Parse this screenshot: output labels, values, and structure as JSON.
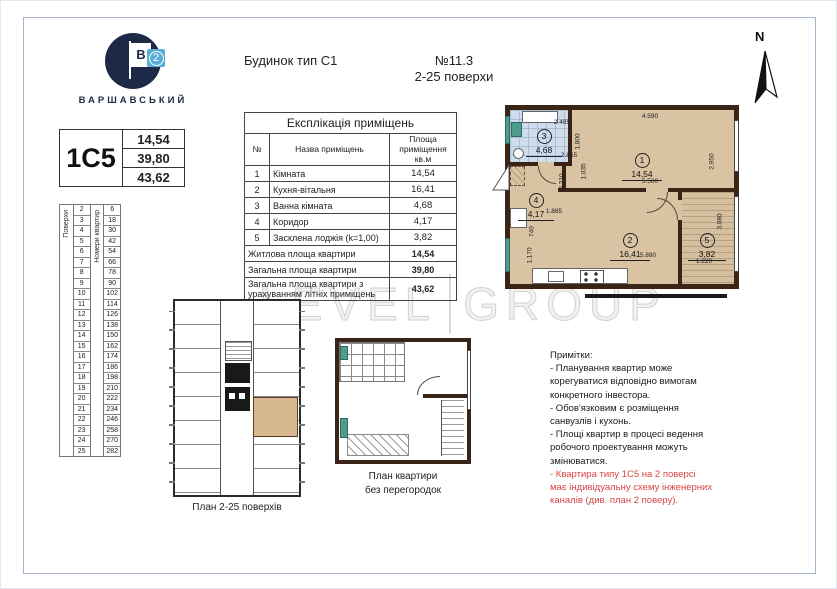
{
  "header": {
    "building_type": "Будинок тип С1",
    "number": "№11.3",
    "floors_range": "2-25 поверхи"
  },
  "brand": {
    "name": "ВАРШАВСЬКИЙ",
    "flag_letter": "В",
    "flag_number": "2"
  },
  "north": {
    "label": "N"
  },
  "apartment_card": {
    "type": "1С5",
    "values": [
      "14,54",
      "39,80",
      "43,62"
    ]
  },
  "floors_table": {
    "col1_label": "Поверхи",
    "col2_label": "Номери квартир",
    "rows": [
      {
        "floor": "2",
        "apt": "6"
      },
      {
        "floor": "3",
        "apt": "18"
      },
      {
        "floor": "4",
        "apt": "30"
      },
      {
        "floor": "5",
        "apt": "42"
      },
      {
        "floor": "6",
        "apt": "54"
      },
      {
        "floor": "7",
        "apt": "66"
      },
      {
        "floor": "8",
        "apt": "78"
      },
      {
        "floor": "9",
        "apt": "90"
      },
      {
        "floor": "10",
        "apt": "102"
      },
      {
        "floor": "11",
        "apt": "114"
      },
      {
        "floor": "12",
        "apt": "126"
      },
      {
        "floor": "13",
        "apt": "138"
      },
      {
        "floor": "14",
        "apt": "150"
      },
      {
        "floor": "15",
        "apt": "162"
      },
      {
        "floor": "16",
        "apt": "174"
      },
      {
        "floor": "17",
        "apt": "186"
      },
      {
        "floor": "18",
        "apt": "198"
      },
      {
        "floor": "19",
        "apt": "210"
      },
      {
        "floor": "20",
        "apt": "222"
      },
      {
        "floor": "21",
        "apt": "234"
      },
      {
        "floor": "22",
        "apt": "246"
      },
      {
        "floor": "23",
        "apt": "258"
      },
      {
        "floor": "24",
        "apt": "270"
      },
      {
        "floor": "25",
        "apt": "282"
      }
    ]
  },
  "explication": {
    "title": "Експлікація приміщень",
    "headers": [
      "№",
      "Назва приміщень",
      "Площа приміщення кв.м"
    ],
    "rows": [
      [
        "1",
        "Кімната",
        "14,54"
      ],
      [
        "2",
        "Кухня-вітальня",
        "16,41"
      ],
      [
        "3",
        "Ванна кімната",
        "4,68"
      ],
      [
        "4",
        "Коридор",
        "4,17"
      ],
      [
        "5",
        "Засклена лоджія (k=1,00)",
        "3,82"
      ]
    ],
    "summary": [
      [
        "Житлова площа квартири",
        "14,54"
      ],
      [
        "Загальна площа квартири",
        "39,80"
      ],
      [
        "Загальна площа квартири з урахуванням літніх приміщень",
        "43,62"
      ]
    ]
  },
  "plan": {
    "rooms": [
      {
        "num": "1",
        "area": "14,54"
      },
      {
        "num": "2",
        "area": "16,41"
      },
      {
        "num": "3",
        "area": "4,68"
      },
      {
        "num": "4",
        "area": "4,17"
      },
      {
        "num": "5",
        "area": "3,82"
      }
    ],
    "dims": {
      "room1_top": "4.590",
      "room1_right": "2.950",
      "room1_bottom": "5.560",
      "bath_top": "2.485",
      "bath_right": "1.800",
      "bath_bottom": "2.855",
      "hall_height": "2.210",
      "hall_right": "1.035",
      "hall_bottom": "1.885",
      "kitchen_left_a": "740",
      "kitchen_left_b": "1.170",
      "kitchen_bottom": "5.880",
      "loggia_right": "3.080",
      "loggia_bottom": "1.220"
    }
  },
  "scalebar": {
    "zero": "0",
    "mid": "2m",
    "end": "5m"
  },
  "watermark": {
    "word1": "LEVEL",
    "word2": "GROUP"
  },
  "captions": {
    "building_plan": "План 2-25 поверхів",
    "no_partitions_1": "План квартири",
    "no_partitions_2": "без перегородок"
  },
  "notes": {
    "lines": [
      {
        "text": "Примітки:",
        "red": false
      },
      {
        "text": "- Планування квартир може",
        "red": false
      },
      {
        "text": "корегуватися відповідно вимогам",
        "red": false
      },
      {
        "text": "конкретного інвестора.",
        "red": false
      },
      {
        "text": "- Обов'язковим є розміщення",
        "red": false
      },
      {
        "text": "санвузлів і кухонь.",
        "red": false
      },
      {
        "text": "- Площі квартир в процесі ведення",
        "red": false
      },
      {
        "text": "робочого проектування можуть",
        "red": false
      },
      {
        "text": "змінюватися.",
        "red": false
      },
      {
        "text": "- Квартира типу 1С5 на 2 поверсі",
        "red": true
      },
      {
        "text": "має індивідуальну схему інженерних",
        "red": true
      },
      {
        "text": "каналів (див. план 2 поверу).",
        "red": true
      }
    ]
  }
}
